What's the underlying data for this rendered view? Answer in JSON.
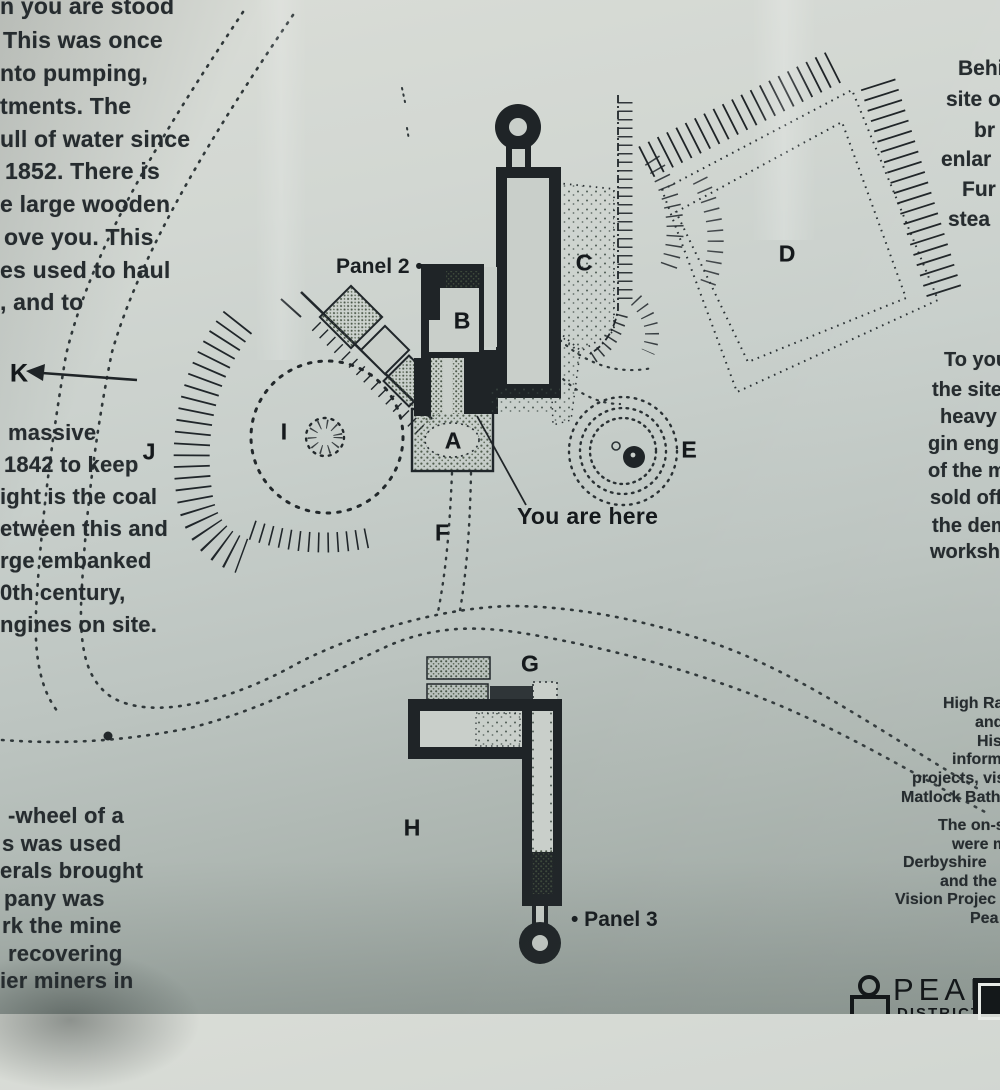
{
  "panel_text": {
    "left_top": [
      "n you are stood",
      "This was once",
      "nto pumping,",
      "tments.  The",
      "ull of water since",
      "1852.  There is",
      "e large wooden",
      "ove you.  This",
      "es used to haul",
      ", and to"
    ],
    "left_mid": [
      "massive",
      "1842 to keep",
      "ight is the coal",
      "etween this and",
      "rge embanked",
      "0th century,",
      "ngines on site."
    ],
    "left_bottom": [
      "-wheel of a",
      "s was used",
      "erals brought",
      "pany was",
      "rk the mine",
      "recovering",
      "ier miners in"
    ],
    "right_top": [
      "Behin",
      "site o",
      "br",
      "enlar",
      "Fur",
      "stea"
    ],
    "right_mid": [
      "To you",
      "the site o",
      "heavy ite",
      "gin engine",
      "of the min",
      "sold off.",
      "the demo",
      "worksho"
    ],
    "right_bottom_1": [
      "High Rak",
      "and",
      "Hist",
      "informa",
      "projects, visi",
      "Matlock Bath,"
    ],
    "right_bottom_2": [
      "The on-sit",
      "were ma",
      "Derbyshire",
      "and the S",
      "Vision Projec",
      "Pea"
    ]
  },
  "map": {
    "labels": {
      "a": "A",
      "b": "B",
      "c": "C",
      "d": "D",
      "e": "E",
      "f": "F",
      "g": "G",
      "h": "H",
      "i": "I",
      "j": "J",
      "k": "K"
    },
    "panel2_label": "Panel 2 •",
    "panel3_label": "• Panel 3",
    "you_are_here": "You are here"
  },
  "footer": {
    "brand": "PEAK",
    "brand_sub": "DISTRICT"
  },
  "colors": {
    "ink": "#1f2427",
    "stipple": "#42503e",
    "paper": "#cbd1cc",
    "dotted_path": "#30383a"
  }
}
